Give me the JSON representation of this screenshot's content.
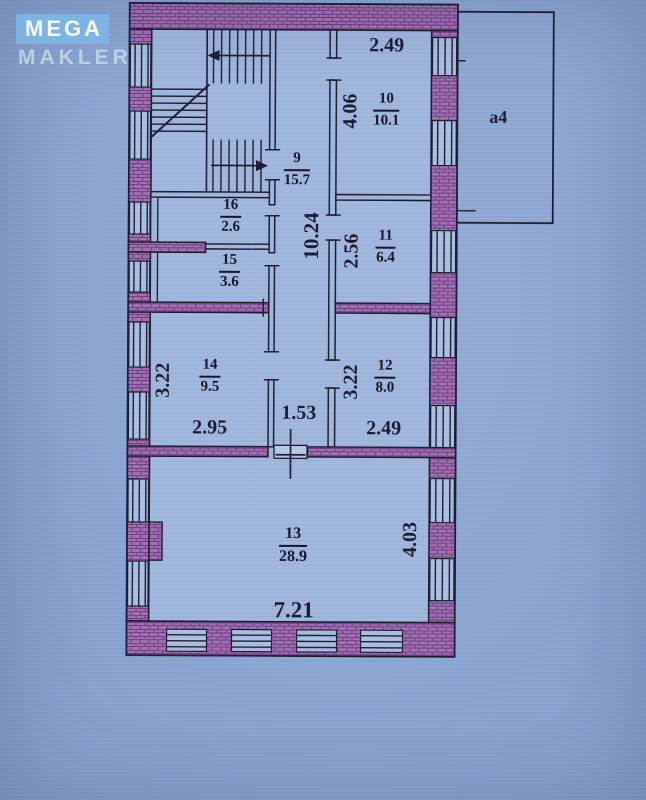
{
  "logo": {
    "title": "MEGA",
    "subtitle": "MAKLER"
  },
  "plan": {
    "annex": {
      "label": "а4"
    },
    "rooms": {
      "r9": {
        "number": "9",
        "area": "15.7"
      },
      "r10": {
        "number": "10",
        "area": "10.1"
      },
      "r11": {
        "number": "11",
        "area": "6.4"
      },
      "r12": {
        "number": "12",
        "area": "8.0"
      },
      "r13": {
        "number": "13",
        "area": "28.9"
      },
      "r14": {
        "number": "14",
        "area": "9.5"
      },
      "r15": {
        "number": "15",
        "area": "3.6"
      },
      "r16": {
        "number": "16",
        "area": "2.6"
      }
    },
    "dims": {
      "top_width": "2.49",
      "room10_height": "4.06",
      "corridor_length": "10.24",
      "room11_height": "2.56",
      "room14_height": "3.22",
      "room14_width": "2.95",
      "corridor_width": "1.53",
      "room12_height": "3.22",
      "room12_width": "2.49",
      "room13_height": "4.03",
      "room13_width": "7.21"
    },
    "colors": {
      "background": "#8ca6d3",
      "wall_fill": "#a26fb3",
      "wall_texture": "#6f4185",
      "line": "#1d1d33",
      "interior": "#a1b7de",
      "logo_accent": "#7fb3e1"
    }
  }
}
